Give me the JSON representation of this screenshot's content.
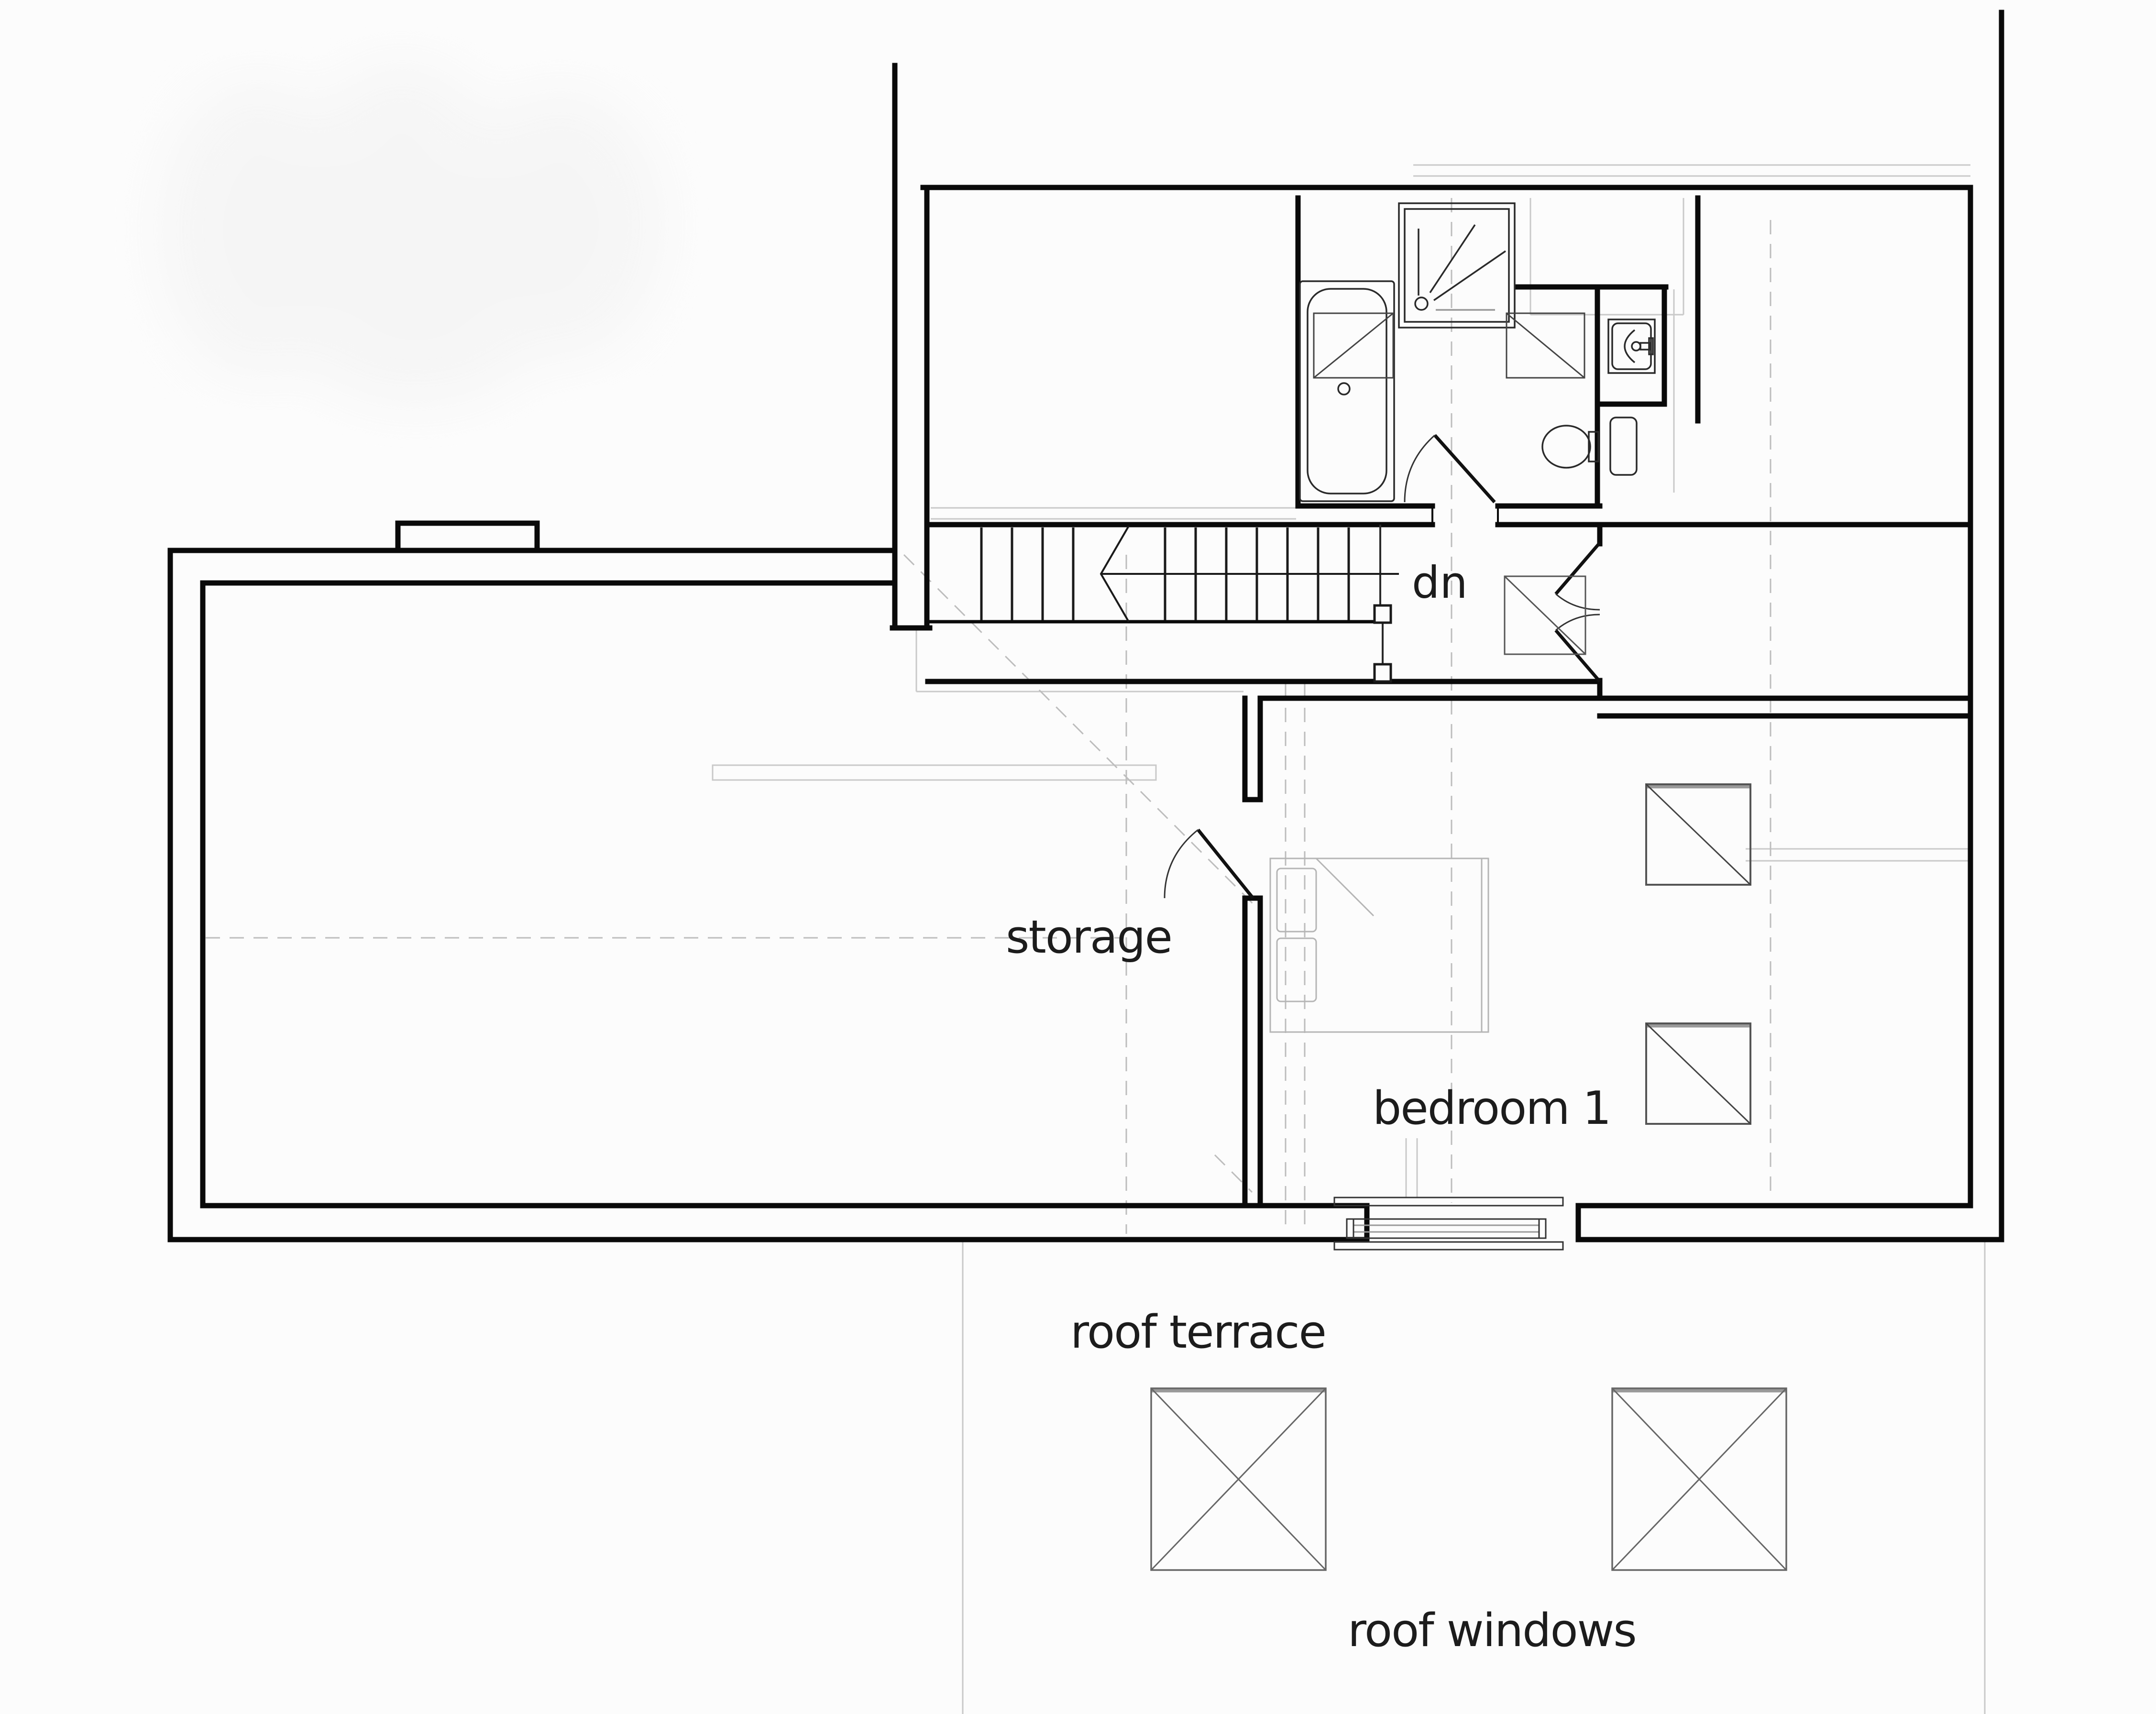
{
  "drawing": {
    "type": "architectural-floor-plan",
    "labels": {
      "stair_direction": "dn",
      "storage_room": "storage",
      "bedroom_1": "bedroom 1",
      "roof_terrace": "roof terrace",
      "roof_windows": "roof windows"
    },
    "rooms": [
      "storage",
      "bedroom 1"
    ],
    "outdoor_areas": [
      "roof terrace"
    ],
    "symbols": [
      "staircase",
      "stair-break-line",
      "door-swing",
      "shower-tray",
      "bathtub",
      "washbasin",
      "toilet",
      "towel-radiator",
      "rooflight",
      "roof-window",
      "terrace-window",
      "bed",
      "chimney",
      "balustrade"
    ],
    "colors": {
      "background": "#fcfcfc",
      "wall": "#0a0a0a",
      "fixture": "#2a2a2a",
      "furniture": "#b5b5b5",
      "construction_faint": "#c9c9c9",
      "dashed_roofline": "#bdbdbd",
      "text": "#1c1c1c"
    }
  }
}
